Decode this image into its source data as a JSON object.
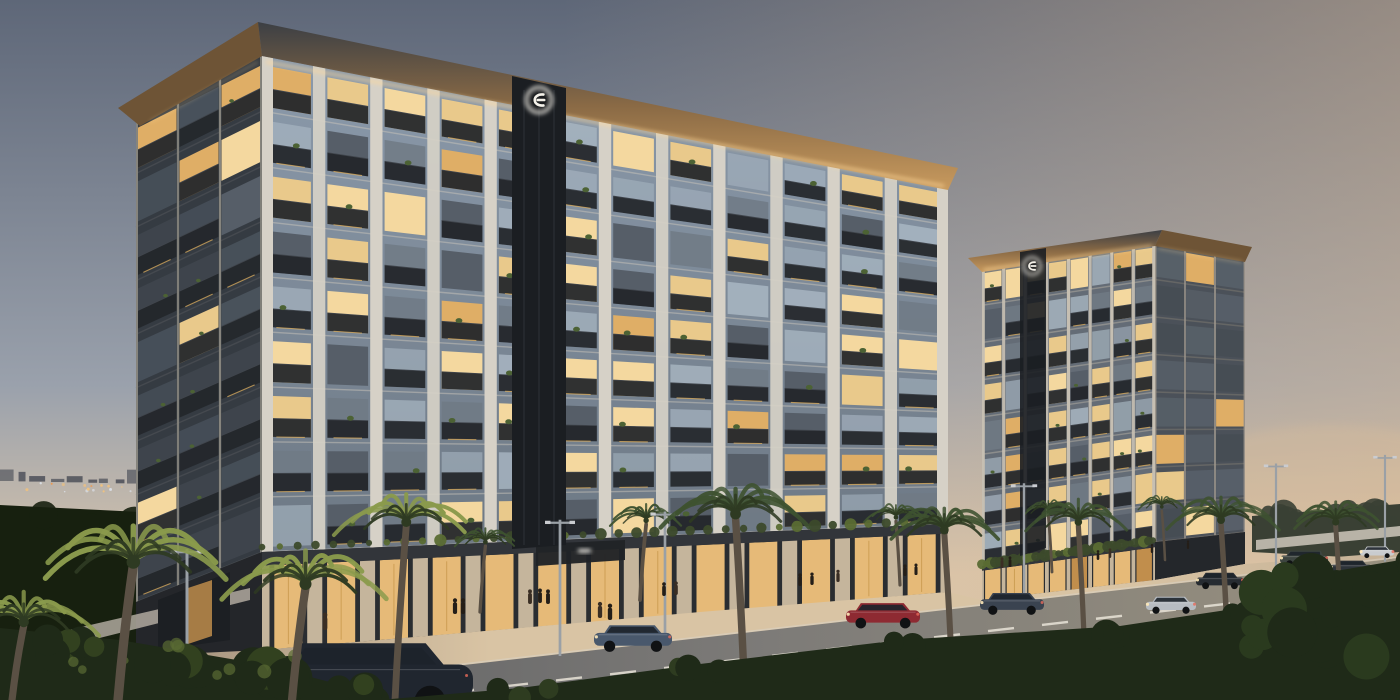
{
  "scene": {
    "description": "Dusk architectural rendering of two modern mid-rise residential buildings with warm lit balconies and storefronts along a palm-lined boulevard with passing cars",
    "time_of_day": "dusk"
  },
  "palette": {
    "sky_top": "#5e6778",
    "sky_mid": "#9aa1ac",
    "sky_horizon": "#d8c5ac",
    "sky_warm_overlay": "#e3bd92",
    "skyline": "#3a3f4b",
    "city_light_warm": "#f2c27c",
    "city_light_cool": "#dfe5ee",
    "tree_dark": "#17200f",
    "tree_right": "#3a4034",
    "wall_white": "#cfc8bc",
    "facade_pier": "#d6d1c7",
    "facade_pier_shadow": "#86847d",
    "west_face": "#353b42",
    "glass_cool": "#a9b7c3",
    "glass_dark": "#565e68",
    "window_warm": "#e9c98b",
    "window_warm2": "#dfae66",
    "window_bright": "#f4d89f",
    "balcony": "#23262b",
    "railing": "#41464d",
    "plant": "#4c6234",
    "roof_fascia": "#3c3f44",
    "roof_wood": "#8a6a45",
    "roof_wood_lit": "#c89a5e",
    "led_glow": "#ffd99a",
    "strip_dark": "#1b1e22",
    "logo_white": "#f5f2ea",
    "podium_glass": "#f0c27c",
    "podium_glass_dim": "#c9934e",
    "podium_column": "#cdbda2",
    "podium_dark": "#2a2d31",
    "hedge": "#3c4a2b",
    "sidewalk_dim": "#8a7b6c",
    "sidewalk_lit": "#d9c4a4",
    "sidewalk_right": "#c4b096",
    "road_near": "#55575b",
    "road_mid": "#7d7b78",
    "road_far": "#99917f",
    "lane_mark": "#e9e4d8",
    "shrub_dark": "#1f2a18",
    "shrub_lit": "#5a6b33",
    "palm_trunk": "#5a5044",
    "palm_frond": "#3e5230",
    "palm_frond_lit": "#8a9a4c",
    "pole": "#9aa0a6",
    "person_dark": "#241e18",
    "car_window": "#1d232b"
  },
  "buildings": {
    "main": {
      "floors": 9,
      "bays": 12,
      "side_bays": 3,
      "lit_ratio": 0.34,
      "logo_icon": "developer-logo-icon"
    },
    "secondary": {
      "floors": 8,
      "bays": 8,
      "side_bays": 3,
      "lit_ratio": 0.42,
      "logo_icon": "developer-logo-icon"
    }
  },
  "street": {
    "street_lights_x": [
      187,
      560,
      665,
      1024,
      1276,
      1385
    ],
    "lane_dash_rows": [
      26,
      60
    ],
    "city_light_count": 55
  },
  "palms": {
    "far": [
      {
        "x": 480,
        "y": 612,
        "s": 0.6
      },
      {
        "x": 640,
        "y": 600,
        "s": 0.68
      },
      {
        "x": 900,
        "y": 585,
        "s": 0.58
      },
      {
        "x": 1052,
        "y": 572,
        "s": 0.52
      },
      {
        "x": 1165,
        "y": 560,
        "s": 0.46
      }
    ],
    "near": [
      {
        "x": 395,
        "y": 700,
        "crown": 520,
        "s": 1.25,
        "lit": true
      },
      {
        "x": 745,
        "y": 700,
        "crown": 512,
        "s": 1.35,
        "lit": false
      },
      {
        "x": 952,
        "y": 672,
        "crown": 528,
        "s": 1.1,
        "lit": false
      },
      {
        "x": 1085,
        "y": 660,
        "crown": 520,
        "s": 0.95,
        "lit": false
      },
      {
        "x": 1228,
        "y": 652,
        "crown": 518,
        "s": 1.0,
        "lit": false
      },
      {
        "x": 1342,
        "y": 640,
        "crown": 520,
        "s": 0.9,
        "lit": false
      }
    ],
    "foreground": [
      {
        "x": 118,
        "y": 700,
        "crown": 560,
        "s": 1.7,
        "lit": true
      },
      {
        "x": 292,
        "y": 700,
        "crown": 582,
        "s": 1.5,
        "lit": true
      },
      {
        "x": 12,
        "y": 700,
        "crown": 620,
        "s": 1.3,
        "lit": true
      }
    ]
  },
  "cars": [
    {
      "x": 258,
      "y": 640,
      "w": 215,
      "color": "#20262f",
      "type": "sedan"
    },
    {
      "x": 594,
      "y": 624,
      "w": 78,
      "color": "#49586c",
      "type": "sedan"
    },
    {
      "x": 846,
      "y": 602,
      "w": 74,
      "color": "#8e2a32",
      "type": "sedan"
    },
    {
      "x": 980,
      "y": 592,
      "w": 64,
      "color": "#3a4350",
      "type": "sedan"
    },
    {
      "x": 1146,
      "y": 596,
      "w": 50,
      "color": "#b7bcc2",
      "type": "sedan"
    },
    {
      "x": 1196,
      "y": 572,
      "w": 48,
      "color": "#262b31",
      "type": "sedan"
    },
    {
      "x": 1280,
      "y": 550,
      "w": 48,
      "color": "#3d4540",
      "type": "suv"
    },
    {
      "x": 1330,
      "y": 560,
      "w": 42,
      "color": "#2d3339",
      "type": "sedan"
    },
    {
      "x": 1360,
      "y": 546,
      "w": 34,
      "color": "#c9cccf",
      "type": "sedan"
    }
  ],
  "people": [
    {
      "x": 325,
      "y": 630
    },
    {
      "x": 455,
      "y": 614
    },
    {
      "x": 463,
      "y": 614
    },
    {
      "x": 530,
      "y": 604
    },
    {
      "x": 540,
      "y": 603
    },
    {
      "x": 548,
      "y": 604
    },
    {
      "x": 600,
      "y": 618
    },
    {
      "x": 610,
      "y": 620
    },
    {
      "x": 664,
      "y": 596
    },
    {
      "x": 676,
      "y": 595
    },
    {
      "x": 800,
      "y": 586
    },
    {
      "x": 812,
      "y": 585
    },
    {
      "x": 838,
      "y": 582
    },
    {
      "x": 905,
      "y": 576
    },
    {
      "x": 916,
      "y": 575
    },
    {
      "x": 1002,
      "y": 568
    },
    {
      "x": 1010,
      "y": 567
    },
    {
      "x": 1098,
      "y": 560
    },
    {
      "x": 1110,
      "y": 558
    },
    {
      "x": 1152,
      "y": 553
    },
    {
      "x": 1188,
      "y": 549
    }
  ]
}
